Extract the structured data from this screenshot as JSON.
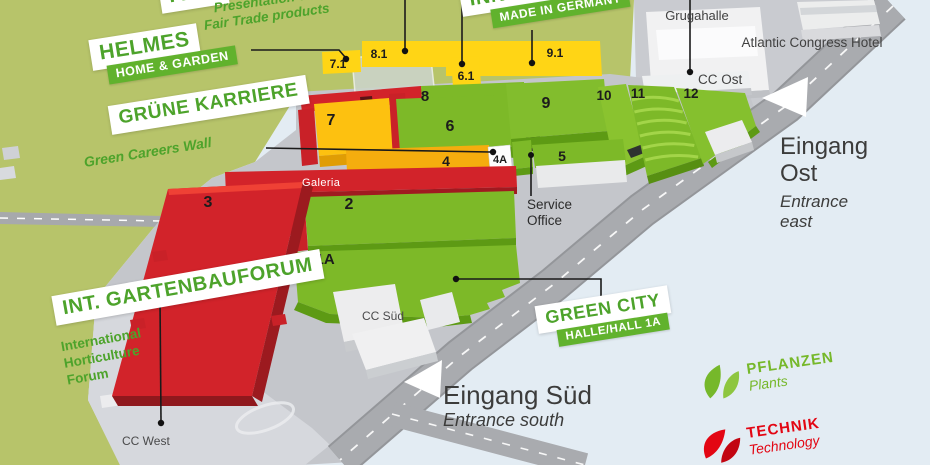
{
  "map": {
    "halls": {
      "h7_1": "7.1",
      "h8_1": "8.1",
      "h6_1": "6.1",
      "h9_1": "9.1",
      "h7": "7",
      "h8": "8",
      "h6": "6",
      "h4": "4",
      "h4a": "4A",
      "h5": "5",
      "h9": "9",
      "h10": "10",
      "h11": "11",
      "h12": "12",
      "h2": "2",
      "h3": "3",
      "h1": "1/1A"
    },
    "places": {
      "grugahalle": "Grugahalle",
      "hotel": "Atlantic Congress Hotel",
      "cc_ost": "CC Ost",
      "cc_sued": "CC Süd",
      "cc_west": "CC West",
      "galeria": "Galeria",
      "service_office": [
        "Service",
        "Office"
      ]
    },
    "callouts": {
      "fairtrade": {
        "title": "FAIR",
        "lines": [
          "Presentation of",
          "Fair Trade products"
        ]
      },
      "helmes": {
        "title": "HELMES",
        "band": "HOME & GARDEN"
      },
      "innovation": {
        "title": "INNOVATION",
        "band": "MADE IN GERMANY"
      },
      "gruene_karriere": {
        "title": "GRÜNE KARRIERE",
        "subtitle": "Green Careers Wall"
      },
      "gartenbauforum": {
        "title": "INT. GARTENBAUFORUM",
        "lines": [
          "International",
          "Horticulture",
          "Forum"
        ]
      },
      "green_city": {
        "title": "GREEN CITY",
        "band": "HALLE/HALL 1A"
      }
    },
    "entrances": {
      "ost": {
        "name_lines": [
          "Eingang",
          "Ost"
        ],
        "translation_lines": [
          "Entrance",
          "east"
        ]
      },
      "sued": {
        "name": "Eingang Süd",
        "translation": "Entrance south"
      }
    },
    "legend": {
      "pflanzen": {
        "label": "PFLANZEN",
        "translation": "Plants",
        "color": "#76b82a"
      },
      "technik": {
        "label": "TECHNIK",
        "translation": "Technology",
        "color": "#e30613"
      }
    },
    "colors": {
      "terrain": "#b7c46a",
      "water_background": "#e3ecf3",
      "hall_green": "#7db928",
      "hall_yellow": "#ffd515",
      "hall_red": "#d2232a"
    }
  }
}
